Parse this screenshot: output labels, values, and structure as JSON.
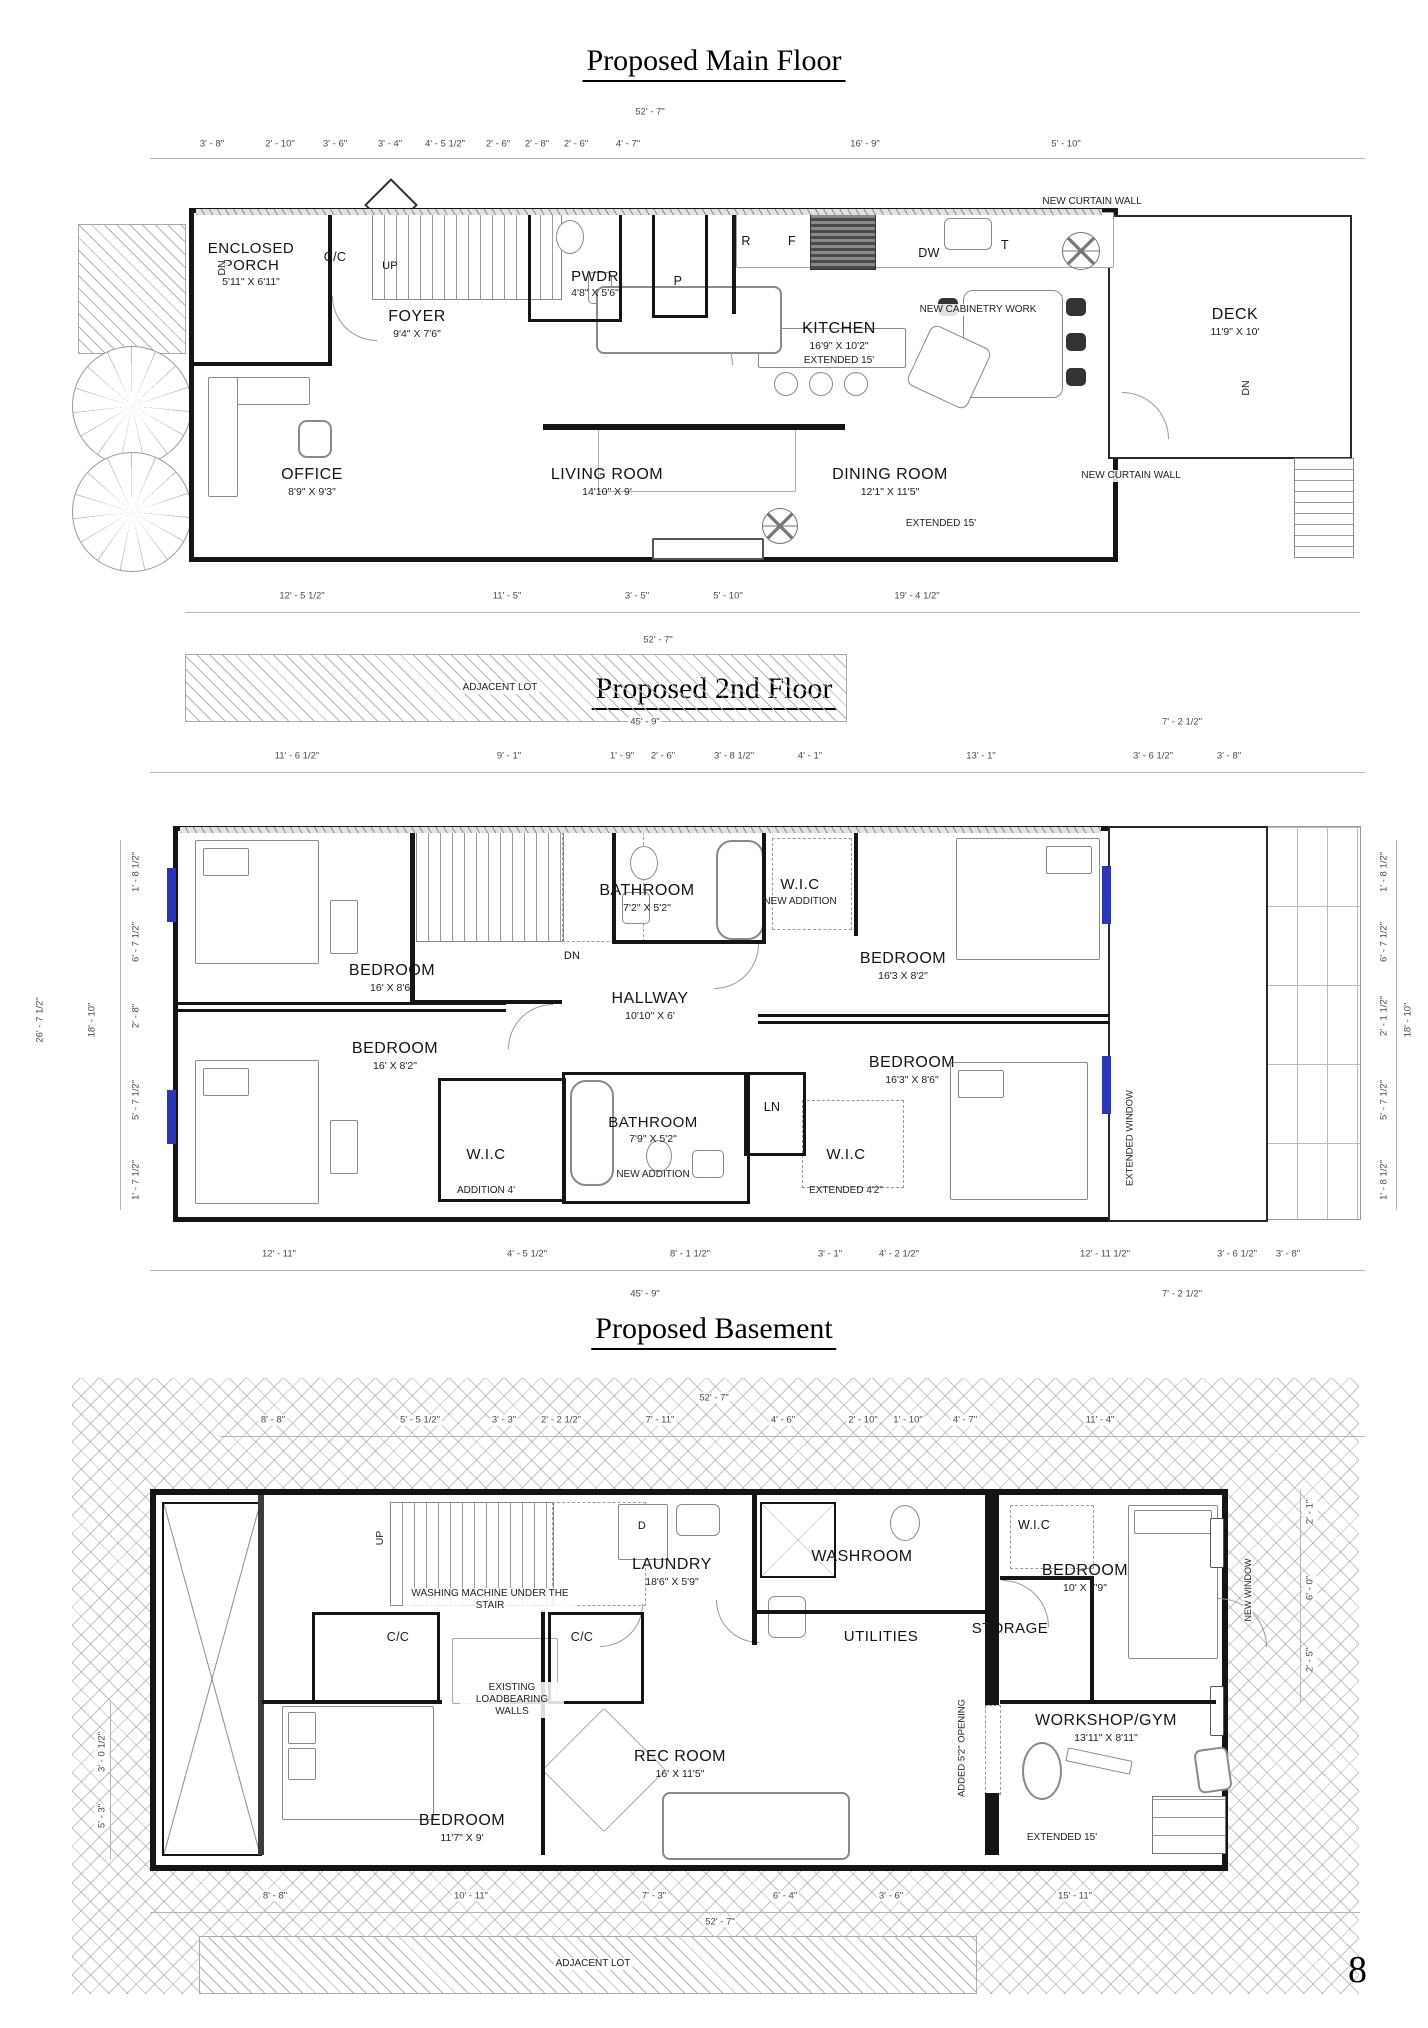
{
  "page_number": "8",
  "main_floor": {
    "title": "Proposed Main Floor",
    "overall_top": "52' - 7\"",
    "overall_bottom": "52' - 7\"",
    "dims_top": [
      "3' - 8\"",
      "2' - 10\"",
      "3' - 6\"",
      "3' - 4\"",
      "4' - 5 1/2\"",
      "2' - 6\"",
      "2' - 8\"",
      "2' - 6\"",
      "4' - 7\"",
      "16' - 9\"",
      "5' - 10\""
    ],
    "dims_bottom": [
      "12' - 5 1/2\"",
      "11' - 5\"",
      "3' - 5\"",
      "5' - 10\"",
      "19' - 4 1/2\""
    ],
    "adjacent_lot_label": "ADJACENT LOT",
    "rooms": {
      "enclosed_porch": {
        "line1": "ENCLOSED",
        "line2": "PORCH",
        "size": "5'11\" X 6'11\""
      },
      "foyer": {
        "name": "FOYER",
        "size": "9'4\" X 7'6\""
      },
      "pwdr": {
        "name": "PWDR",
        "size": "4'8\" X 5'6\""
      },
      "kitchen": {
        "name": "KITCHEN",
        "size": "16'9\" X 10'2\"",
        "note": "EXTENDED 15'"
      },
      "office": {
        "name": "OFFICE",
        "size": "8'9\" X 9'3\""
      },
      "living_room": {
        "name": "LIVING ROOM",
        "size": "14'10\" X 9'"
      },
      "dining_room": {
        "name": "DINING ROOM",
        "size": "12'1\" X 11'5\"",
        "note": "EXTENDED 15'"
      },
      "deck": {
        "name": "DECK",
        "size": "11'9\" X 10'"
      }
    },
    "labels": {
      "cc": "C/C",
      "up": "UP",
      "dn": "DN",
      "p": "P",
      "r": "R",
      "f": "F",
      "dw": "DW",
      "t": "T",
      "new_curtain_wall": "NEW CURTAIN WALL",
      "new_cabinetry_work": "NEW CABINETRY WORK"
    }
  },
  "second_floor": {
    "title": "Proposed 2nd Floor",
    "overall_top": "45' - 9\"",
    "overall_top_right": "7' - 2 1/2\"",
    "overall_bottom": "45' - 9\"",
    "overall_bottom_right": "7' - 2 1/2\"",
    "dims_top": [
      "11' - 6 1/2\"",
      "9' - 1\"",
      "1' - 9\"",
      "2' - 6\"",
      "3' - 8 1/2\"",
      "4' - 1\"",
      "13' - 1\"",
      "3' - 6 1/2\"",
      "3' - 8\""
    ],
    "dims_bottom": [
      "12' - 11\"",
      "4' - 5 1/2\"",
      "8' - 1 1/2\"",
      "3' - 1\"",
      "4' - 2 1/2\"",
      "12' - 11 1/2\"",
      "3' - 6 1/2\"",
      "3' - 8\""
    ],
    "dims_left_overall": [
      "26' - 7 1/2\"",
      "18' - 10\""
    ],
    "dims_left_small": [
      "1' - 8 1/2\"",
      "6' - 7 1/2\"",
      "2' - 8\"",
      "5' - 7 1/2\"",
      "1' - 7 1/2\""
    ],
    "dims_right_overall": [
      "18' - 10\""
    ],
    "dims_right_small": [
      "1' - 8 1/2\"",
      "6' - 7 1/2\"",
      "2' - 1 1/2\"",
      "5' - 7 1/2\"",
      "1' - 8 1/2\""
    ],
    "rooms": {
      "bathroom_top": {
        "name": "BATHROOM",
        "size": "7'2\" X 5'2\""
      },
      "wic_top": {
        "name": "W.I.C",
        "note": "NEW ADDITION"
      },
      "bedroom_tl": {
        "name": "BEDROOM",
        "size": "16' X 8'6\""
      },
      "bedroom_tr": {
        "name": "BEDROOM",
        "size": "16'3 X 8'2\""
      },
      "hallway": {
        "name": "HALLWAY",
        "size": "10'10\" X 6'"
      },
      "bedroom_bl": {
        "name": "BEDROOM",
        "size": "16' X 8'2\""
      },
      "bedroom_br": {
        "name": "BEDROOM",
        "size": "16'3\" X 8'6\""
      },
      "wic_bl": {
        "name": "W.I.C",
        "note": "ADDITION 4'"
      },
      "bathroom_bottom": {
        "name": "BATHROOM",
        "size": "7'9\" X 5'2\"",
        "note": "NEW ADDITION"
      },
      "ln": {
        "name": "LN"
      },
      "wic_br": {
        "name": "W.I.C",
        "note": "EXTENDED 4'2\""
      }
    },
    "labels": {
      "dn": "DN",
      "extended_window": "EXTENDED WINDOW"
    }
  },
  "basement": {
    "title": "Proposed Basement",
    "overall_top": "52' - 7\"",
    "overall_bottom": "52' - 7\"",
    "dims_top": [
      "8' - 8\"",
      "5' - 5 1/2\"",
      "3' - 3\"",
      "2' - 2 1/2\"",
      "7' - 11\"",
      "4' - 6\"",
      "2' - 10\"",
      "1' - 10\"",
      "4' - 7\"",
      "11' - 4\""
    ],
    "dims_bottom": [
      "8' - 8\"",
      "10' - 11\"",
      "7' - 3\"",
      "6' - 4\"",
      "3' - 6\"",
      "15' - 11\""
    ],
    "dims_left": [
      "3' - 0 1/2\"",
      "5' - 3\""
    ],
    "dims_right": [
      "2' - 1\"",
      "6' - 0\"",
      "2' - 5\""
    ],
    "adjacent_lot_label": "ADJACENT LOT",
    "rooms": {
      "laundry": {
        "name": "LAUNDRY",
        "size": "18'6\" X 5'9\""
      },
      "washroom": {
        "name": "WASHROOM"
      },
      "utilities": {
        "name": "UTILITIES"
      },
      "wic": {
        "name": "W.I.C"
      },
      "storage": {
        "name": "STORAGE"
      },
      "bedroom_right": {
        "name": "BEDROOM",
        "size": "10' X 7'9\""
      },
      "workshop": {
        "name": "WORKSHOP/GYM",
        "size": "13'11\" X 8'11\"",
        "note": "EXTENDED 15'"
      },
      "rec_room": {
        "name": "REC ROOM",
        "size": "16' X 11'5\""
      },
      "bedroom_left": {
        "name": "BEDROOM",
        "size": "11'7\" X 9'"
      }
    },
    "labels": {
      "up": "UP",
      "d": "D",
      "cc": "C/C",
      "washing_machine": "WASHING MACHINE UNDER THE STAIR",
      "existing_walls": "EXISTING LOADBEARING WALLS",
      "added_opening": "ADDED 5'2\" OPENING",
      "new_window": "NEW WINDOW"
    }
  }
}
